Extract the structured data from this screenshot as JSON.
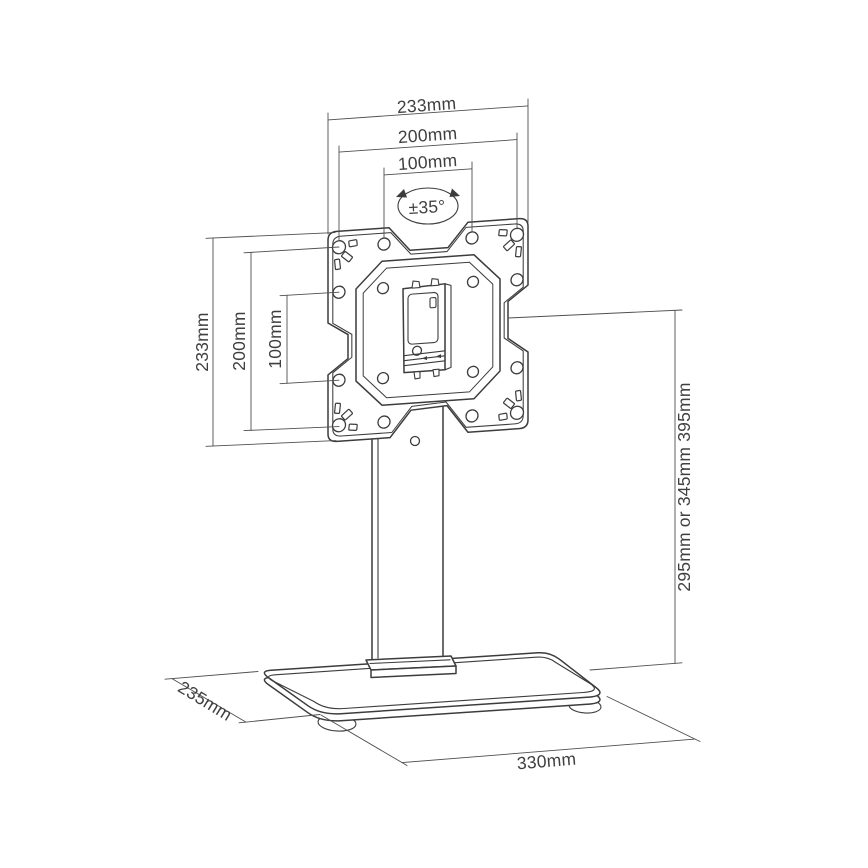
{
  "diagram": {
    "kind": "technical-line-drawing",
    "subject": "monitor stand with VESA mounting plate, column and pedestal base",
    "colors": {
      "line": "#3c3c3c",
      "dimension_line": "#4f4f4f",
      "text": "#3f3f3f",
      "background": "#ffffff"
    },
    "dims": {
      "plate_width_outer": "233mm",
      "plate_width_vesa200": "200mm",
      "plate_width_vesa100": "100mm",
      "plate_height_outer": "233mm",
      "plate_height_vesa200": "200mm",
      "plate_height_vesa100": "100mm",
      "stand_height_options": "295mm or 345mm 395mm",
      "base_depth": "235mm",
      "base_width": "330mm",
      "swivel_angle": "±35°"
    }
  }
}
